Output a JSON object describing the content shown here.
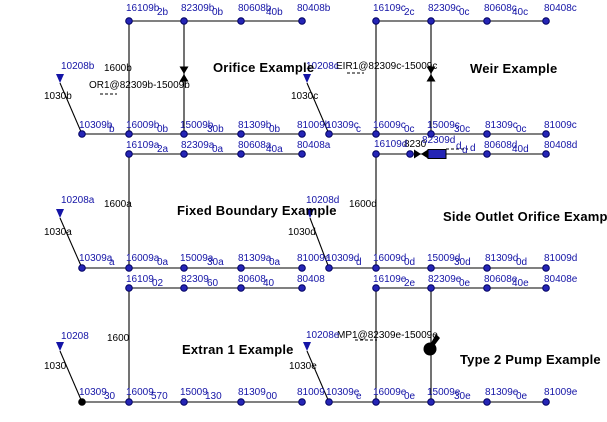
{
  "canvas": {
    "width": 607,
    "height": 422,
    "background": "#ffffff"
  },
  "colors": {
    "node_fill": "#2525b5",
    "node_stroke": "#000060",
    "node_label": "#1414a6",
    "annotation": "#000000",
    "line": "#000000",
    "outfall_node": "#000000"
  },
  "diagram": {
    "titles": [
      {
        "t": "Orifice Example",
        "x": 213,
        "y": 62
      },
      {
        "t": "Weir Example",
        "x": 470,
        "y": 63
      },
      {
        "t": "Fixed Boundary Example",
        "x": 177,
        "y": 205
      },
      {
        "t": "Side Outlet Orifice Example",
        "x": 443,
        "y": 211
      },
      {
        "t": "Extran 1 Example",
        "x": 182,
        "y": 344
      },
      {
        "t": "Type 2 Pump Example",
        "x": 460,
        "y": 354
      }
    ],
    "labels": [
      {
        "t": "1600b",
        "x": 104,
        "y": 64,
        "k": "ann"
      },
      {
        "t": "OR1@82309b-15009b",
        "x": 89,
        "y": 81,
        "k": "ann"
      },
      {
        "t": "1030b",
        "x": 44,
        "y": 92,
        "k": "ann"
      },
      {
        "t": "EIR1@82309c-15009c",
        "x": 336,
        "y": 62,
        "k": "ann"
      },
      {
        "t": "1030c",
        "x": 291,
        "y": 92,
        "k": "ann"
      },
      {
        "t": "1600a",
        "x": 104,
        "y": 200,
        "k": "ann"
      },
      {
        "t": "1030a",
        "x": 44,
        "y": 228,
        "k": "ann"
      },
      {
        "t": "1600d",
        "x": 349,
        "y": 200,
        "k": "ann"
      },
      {
        "t": "8230",
        "x": 404,
        "y": 140,
        "k": "ann"
      },
      {
        "t": "1030d",
        "x": 288,
        "y": 228,
        "k": "ann"
      },
      {
        "t": "1600",
        "x": 107,
        "y": 334,
        "k": "ann"
      },
      {
        "t": "1030",
        "x": 44,
        "y": 362,
        "k": "ann"
      },
      {
        "t": "MP1@82309e-15009e",
        "x": 337,
        "y": 331,
        "k": "ann"
      },
      {
        "t": "1030e",
        "x": 289,
        "y": 362,
        "k": "ann"
      },
      {
        "t": "10208b",
        "x": 61,
        "y": 62,
        "k": "node"
      },
      {
        "t": "10208c",
        "x": 306,
        "y": 62,
        "k": "node"
      },
      {
        "t": "10208a",
        "x": 61,
        "y": 196,
        "k": "node"
      },
      {
        "t": "10208d",
        "x": 306,
        "y": 196,
        "k": "node"
      },
      {
        "t": "10208",
        "x": 61,
        "y": 332,
        "k": "node"
      },
      {
        "t": "10208e",
        "x": 306,
        "y": 331,
        "k": "node"
      },
      {
        "t": "16109b",
        "x": 126,
        "y": 4,
        "k": "node"
      },
      {
        "t": "2b",
        "x": 157,
        "y": 8,
        "k": "frag"
      },
      {
        "t": "82309b",
        "x": 181,
        "y": 4,
        "k": "node"
      },
      {
        "t": "0b",
        "x": 212,
        "y": 8,
        "k": "frag"
      },
      {
        "t": "80608b",
        "x": 238,
        "y": 4,
        "k": "node"
      },
      {
        "t": "40b",
        "x": 266,
        "y": 8,
        "k": "frag"
      },
      {
        "t": "80408b",
        "x": 297,
        "y": 4,
        "k": "node"
      },
      {
        "t": "16109c",
        "x": 373,
        "y": 4,
        "k": "node"
      },
      {
        "t": "2c",
        "x": 404,
        "y": 8,
        "k": "frag"
      },
      {
        "t": "82309c",
        "x": 428,
        "y": 4,
        "k": "node"
      },
      {
        "t": "0c",
        "x": 459,
        "y": 8,
        "k": "frag"
      },
      {
        "t": "80608c",
        "x": 484,
        "y": 4,
        "k": "node"
      },
      {
        "t": "40c",
        "x": 512,
        "y": 8,
        "k": "frag"
      },
      {
        "t": "80408c",
        "x": 544,
        "y": 4,
        "k": "node"
      },
      {
        "t": "10309b",
        "x": 79,
        "y": 121,
        "k": "node"
      },
      {
        "t": "b",
        "x": 109,
        "y": 125,
        "k": "frag"
      },
      {
        "t": "16009b",
        "x": 126,
        "y": 121,
        "k": "node"
      },
      {
        "t": "0b",
        "x": 157,
        "y": 125,
        "k": "frag"
      },
      {
        "t": "15009b",
        "x": 180,
        "y": 121,
        "k": "node"
      },
      {
        "t": "30b",
        "x": 207,
        "y": 125,
        "k": "frag"
      },
      {
        "t": "81309b",
        "x": 238,
        "y": 121,
        "k": "node"
      },
      {
        "t": "0b",
        "x": 269,
        "y": 125,
        "k": "frag"
      },
      {
        "t": "81009b",
        "x": 297,
        "y": 121,
        "k": "node"
      },
      {
        "t": "10309c",
        "x": 326,
        "y": 121,
        "k": "node"
      },
      {
        "t": "c",
        "x": 356,
        "y": 125,
        "k": "frag"
      },
      {
        "t": "16009c",
        "x": 373,
        "y": 121,
        "k": "node"
      },
      {
        "t": "0c",
        "x": 404,
        "y": 125,
        "k": "frag"
      },
      {
        "t": "15009c",
        "x": 427,
        "y": 121,
        "k": "node"
      },
      {
        "t": "30c",
        "x": 454,
        "y": 125,
        "k": "frag"
      },
      {
        "t": "81309c",
        "x": 485,
        "y": 121,
        "k": "node"
      },
      {
        "t": "0c",
        "x": 516,
        "y": 125,
        "k": "frag"
      },
      {
        "t": "81009c",
        "x": 544,
        "y": 121,
        "k": "node"
      },
      {
        "t": "16109a",
        "x": 126,
        "y": 141,
        "k": "node"
      },
      {
        "t": "2a",
        "x": 157,
        "y": 145,
        "k": "frag"
      },
      {
        "t": "82309a",
        "x": 181,
        "y": 141,
        "k": "node"
      },
      {
        "t": "0a",
        "x": 212,
        "y": 145,
        "k": "frag"
      },
      {
        "t": "80608a",
        "x": 238,
        "y": 141,
        "k": "node"
      },
      {
        "t": "40a",
        "x": 266,
        "y": 145,
        "k": "frag"
      },
      {
        "t": "80408a",
        "x": 297,
        "y": 141,
        "k": "node"
      },
      {
        "t": "16109d",
        "x": 374,
        "y": 140,
        "k": "node"
      },
      {
        "t": "82309d",
        "x": 422,
        "y": 136,
        "k": "node"
      },
      {
        "t": "d",
        "x": 456,
        "y": 142,
        "k": "frag"
      },
      {
        "t": "d",
        "x": 462,
        "y": 146,
        "k": "frag"
      },
      {
        "t": "d",
        "x": 470,
        "y": 144,
        "k": "frag"
      },
      {
        "t": "80608d",
        "x": 484,
        "y": 141,
        "k": "node"
      },
      {
        "t": "40d",
        "x": 512,
        "y": 145,
        "k": "frag"
      },
      {
        "t": "80408d",
        "x": 544,
        "y": 141,
        "k": "node"
      },
      {
        "t": "10309a",
        "x": 79,
        "y": 254,
        "k": "node"
      },
      {
        "t": "a",
        "x": 109,
        "y": 258,
        "k": "frag"
      },
      {
        "t": "16009a",
        "x": 126,
        "y": 254,
        "k": "node"
      },
      {
        "t": "0a",
        "x": 157,
        "y": 258,
        "k": "frag"
      },
      {
        "t": "15009a",
        "x": 180,
        "y": 254,
        "k": "node"
      },
      {
        "t": "30a",
        "x": 207,
        "y": 258,
        "k": "frag"
      },
      {
        "t": "81309a",
        "x": 238,
        "y": 254,
        "k": "node"
      },
      {
        "t": "0a",
        "x": 269,
        "y": 258,
        "k": "frag"
      },
      {
        "t": "81009a",
        "x": 297,
        "y": 254,
        "k": "node"
      },
      {
        "t": "10309d",
        "x": 326,
        "y": 254,
        "k": "node"
      },
      {
        "t": "d",
        "x": 356,
        "y": 258,
        "k": "frag"
      },
      {
        "t": "16009d",
        "x": 373,
        "y": 254,
        "k": "node"
      },
      {
        "t": "0d",
        "x": 404,
        "y": 258,
        "k": "frag"
      },
      {
        "t": "15009d",
        "x": 427,
        "y": 254,
        "k": "node"
      },
      {
        "t": "30d",
        "x": 454,
        "y": 258,
        "k": "frag"
      },
      {
        "t": "81309d",
        "x": 485,
        "y": 254,
        "k": "node"
      },
      {
        "t": "0d",
        "x": 516,
        "y": 258,
        "k": "frag"
      },
      {
        "t": "81009d",
        "x": 544,
        "y": 254,
        "k": "node"
      },
      {
        "t": "16109",
        "x": 126,
        "y": 275,
        "k": "node"
      },
      {
        "t": "02",
        "x": 152,
        "y": 279,
        "k": "frag"
      },
      {
        "t": "82309",
        "x": 181,
        "y": 275,
        "k": "node"
      },
      {
        "t": "60",
        "x": 207,
        "y": 279,
        "k": "frag"
      },
      {
        "t": "80608",
        "x": 238,
        "y": 275,
        "k": "node"
      },
      {
        "t": "40",
        "x": 263,
        "y": 279,
        "k": "frag"
      },
      {
        "t": "80408",
        "x": 297,
        "y": 275,
        "k": "node"
      },
      {
        "t": "16109e",
        "x": 373,
        "y": 275,
        "k": "node"
      },
      {
        "t": "2e",
        "x": 404,
        "y": 279,
        "k": "frag"
      },
      {
        "t": "82309e",
        "x": 428,
        "y": 275,
        "k": "node"
      },
      {
        "t": "0e",
        "x": 459,
        "y": 279,
        "k": "frag"
      },
      {
        "t": "80608e",
        "x": 484,
        "y": 275,
        "k": "node"
      },
      {
        "t": "40e",
        "x": 512,
        "y": 279,
        "k": "frag"
      },
      {
        "t": "80408e",
        "x": 544,
        "y": 275,
        "k": "node"
      },
      {
        "t": "10309",
        "x": 79,
        "y": 388,
        "k": "node"
      },
      {
        "t": "30",
        "x": 104,
        "y": 392,
        "k": "frag"
      },
      {
        "t": "16009",
        "x": 126,
        "y": 388,
        "k": "node"
      },
      {
        "t": "570",
        "x": 151,
        "y": 392,
        "k": "frag"
      },
      {
        "t": "15009",
        "x": 180,
        "y": 388,
        "k": "node"
      },
      {
        "t": "130",
        "x": 205,
        "y": 392,
        "k": "frag"
      },
      {
        "t": "81309",
        "x": 238,
        "y": 388,
        "k": "node"
      },
      {
        "t": "00",
        "x": 266,
        "y": 392,
        "k": "frag"
      },
      {
        "t": "81009",
        "x": 297,
        "y": 388,
        "k": "node"
      },
      {
        "t": "10309e",
        "x": 326,
        "y": 388,
        "k": "node"
      },
      {
        "t": "e",
        "x": 356,
        "y": 392,
        "k": "frag"
      },
      {
        "t": "16009e",
        "x": 373,
        "y": 388,
        "k": "node"
      },
      {
        "t": "0e",
        "x": 404,
        "y": 392,
        "k": "frag"
      },
      {
        "t": "15009e",
        "x": 427,
        "y": 388,
        "k": "node"
      },
      {
        "t": "30e",
        "x": 454,
        "y": 392,
        "k": "frag"
      },
      {
        "t": "81309e",
        "x": 485,
        "y": 388,
        "k": "node"
      },
      {
        "t": "0e",
        "x": 516,
        "y": 392,
        "k": "frag"
      },
      {
        "t": "81009e",
        "x": 544,
        "y": 388,
        "k": "node"
      }
    ],
    "lines": [
      [
        129,
        21,
        302,
        21,
        0
      ],
      [
        376,
        21,
        546,
        21,
        0
      ],
      [
        82,
        134,
        302,
        134,
        0
      ],
      [
        329,
        134,
        546,
        134,
        0
      ],
      [
        129,
        154,
        302,
        154,
        0
      ],
      [
        376,
        154,
        546,
        154,
        0
      ],
      [
        82,
        268,
        302,
        268,
        0
      ],
      [
        329,
        268,
        546,
        268,
        0
      ],
      [
        129,
        288,
        302,
        288,
        0
      ],
      [
        376,
        288,
        546,
        288,
        0
      ],
      [
        82,
        402,
        302,
        402,
        0
      ],
      [
        329,
        402,
        546,
        402,
        0
      ],
      [
        129,
        21,
        129,
        134,
        0
      ],
      [
        184,
        21,
        184,
        134,
        0
      ],
      [
        376,
        21,
        376,
        134,
        0
      ],
      [
        431,
        21,
        431,
        134,
        0
      ],
      [
        129,
        154,
        129,
        268,
        0
      ],
      [
        376,
        154,
        376,
        268,
        0
      ],
      [
        129,
        288,
        129,
        402,
        0
      ],
      [
        376,
        288,
        376,
        402,
        0
      ],
      [
        431,
        288,
        431,
        402,
        0
      ],
      [
        60,
        83,
        82,
        134,
        0
      ],
      [
        307,
        83,
        329,
        134,
        0
      ],
      [
        60,
        218,
        82,
        268,
        0
      ],
      [
        310,
        218,
        329,
        268,
        0
      ],
      [
        60,
        351,
        82,
        402,
        0
      ],
      [
        307,
        351,
        329,
        402,
        0
      ],
      [
        100,
        94,
        117,
        94,
        1
      ],
      [
        347,
        73,
        364,
        73,
        1
      ],
      [
        446,
        149,
        468,
        149,
        1
      ],
      [
        355,
        340,
        377,
        340,
        1
      ]
    ],
    "nodes": [
      [
        129,
        21
      ],
      [
        184,
        21
      ],
      [
        241,
        21
      ],
      [
        302,
        21
      ],
      [
        82,
        134
      ],
      [
        129,
        134
      ],
      [
        184,
        134
      ],
      [
        241,
        134
      ],
      [
        302,
        134
      ],
      [
        376,
        21
      ],
      [
        431,
        21
      ],
      [
        487,
        21
      ],
      [
        546,
        21
      ],
      [
        329,
        134
      ],
      [
        376,
        134
      ],
      [
        431,
        134
      ],
      [
        487,
        134
      ],
      [
        546,
        134
      ],
      [
        129,
        154
      ],
      [
        184,
        154
      ],
      [
        241,
        154
      ],
      [
        302,
        154
      ],
      [
        82,
        268
      ],
      [
        129,
        268
      ],
      [
        184,
        268
      ],
      [
        241,
        268
      ],
      [
        302,
        268
      ],
      [
        376,
        154
      ],
      [
        410,
        154
      ],
      [
        487,
        154
      ],
      [
        546,
        154
      ],
      [
        329,
        268
      ],
      [
        376,
        268
      ],
      [
        431,
        268
      ],
      [
        487,
        268
      ],
      [
        546,
        268
      ],
      [
        129,
        288
      ],
      [
        184,
        288
      ],
      [
        241,
        288
      ],
      [
        302,
        288
      ],
      [
        82,
        402,
        "k"
      ],
      [
        129,
        402
      ],
      [
        184,
        402
      ],
      [
        241,
        402
      ],
      [
        302,
        402
      ],
      [
        376,
        288
      ],
      [
        431,
        288
      ],
      [
        487,
        288
      ],
      [
        546,
        288
      ],
      [
        329,
        402
      ],
      [
        376,
        402
      ],
      [
        431,
        402
      ],
      [
        487,
        402
      ],
      [
        546,
        402
      ]
    ],
    "triangles": [
      {
        "x": 60,
        "y": 74,
        "name": "inlet-marker-10208b"
      },
      {
        "x": 307,
        "y": 74,
        "name": "inlet-marker-10208c"
      },
      {
        "x": 60,
        "y": 209,
        "name": "inlet-marker-10208a"
      },
      {
        "x": 310,
        "y": 209,
        "name": "inlet-marker-10208d"
      },
      {
        "x": 60,
        "y": 342,
        "name": "inlet-marker-10208"
      },
      {
        "x": 307,
        "y": 342,
        "name": "inlet-marker-10208e"
      }
    ],
    "bowties": [
      {
        "x": 184,
        "y": 74,
        "name": "orifice-symbol"
      },
      {
        "x": 431,
        "y": 74,
        "name": "weir-symbol"
      }
    ],
    "side_outlet": {
      "tip_x": 421,
      "y": 154,
      "half": 4.5,
      "rect": [
        428,
        149.5,
        18,
        9
      ]
    },
    "pump": {
      "cx": 430,
      "cy": 349,
      "r": 6.5
    }
  }
}
